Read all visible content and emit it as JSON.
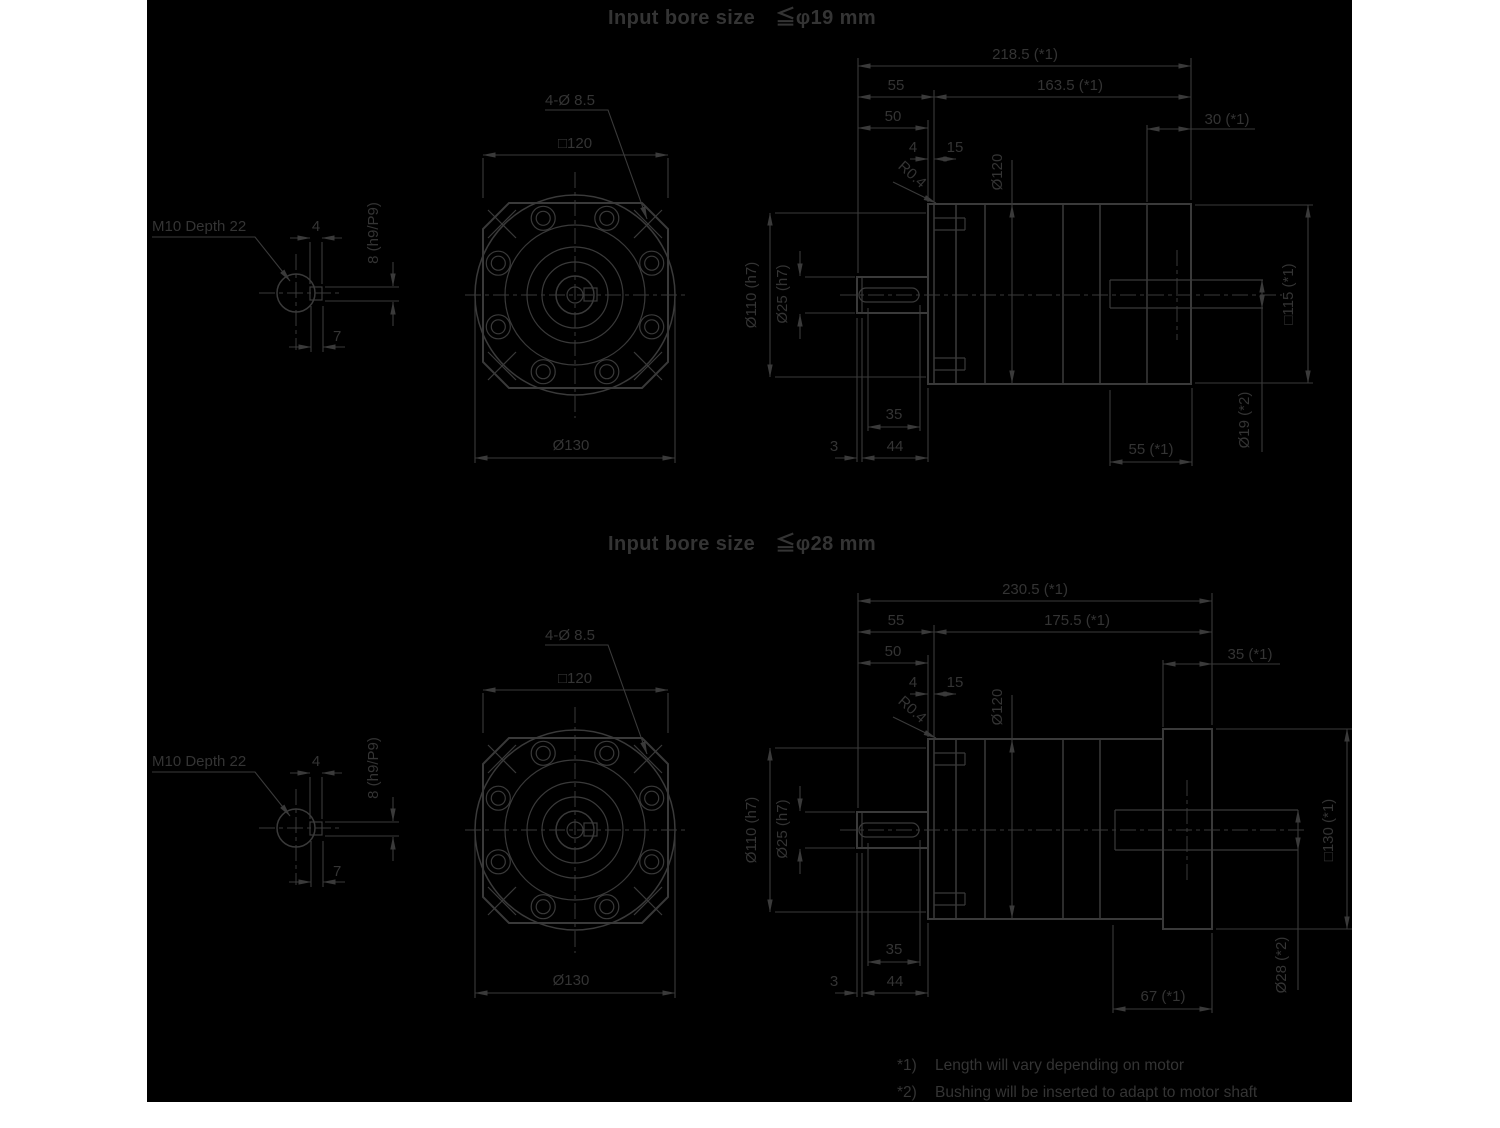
{
  "colors": {
    "page": "#ffffff",
    "canvas": "#000000",
    "line": "#3a3a3a",
    "text": "#343434"
  },
  "drawings": [
    {
      "title": "Input bore size　≦φ19 mm",
      "keyway": {
        "thread": "M10 Depth 22",
        "width": "4",
        "height": "8 (h9/P9)",
        "depth": "7"
      },
      "front": {
        "holes": "4-Ø 8.5",
        "square": "□120",
        "outer": "Ø130"
      },
      "side": {
        "total": "218.5 (*1)",
        "left": "55",
        "right": "163.5 (*1)",
        "shaft_len": "50",
        "flange_depth": "30 (*1)",
        "step": "4",
        "plate": "15",
        "fillet": "R0.4",
        "body": "Ø120",
        "pilot": "Ø110 (h7)",
        "shaft": "Ø25 (h7)",
        "square": "□115 (*1)",
        "bore": "Ø19 (*2)",
        "key": "35",
        "tip": "3",
        "slen": "44",
        "clamp": "55 (*1)"
      }
    },
    {
      "title": "Input bore size　≦φ28 mm",
      "keyway": {
        "thread": "M10 Depth 22",
        "width": "4",
        "height": "8 (h9/P9)",
        "depth": "7"
      },
      "front": {
        "holes": "4-Ø 8.5",
        "square": "□120",
        "outer": "Ø130"
      },
      "side": {
        "total": "230.5 (*1)",
        "left": "55",
        "right": "175.5 (*1)",
        "shaft_len": "50",
        "flange_depth": "35 (*1)",
        "step": "4",
        "plate": "15",
        "fillet": "R0.4",
        "body": "Ø120",
        "pilot": "Ø110 (h7)",
        "shaft": "Ø25 (h7)",
        "square": "□130 (*1)",
        "bore": "Ø28 (*2)",
        "key": "35",
        "tip": "3",
        "slen": "44",
        "clamp": "67 (*1)"
      }
    }
  ],
  "footnotes": [
    {
      "marker": "*1)",
      "text": "Length will vary depending on motor"
    },
    {
      "marker": "*2)",
      "text": "Bushing will be inserted to adapt to motor shaft"
    }
  ]
}
